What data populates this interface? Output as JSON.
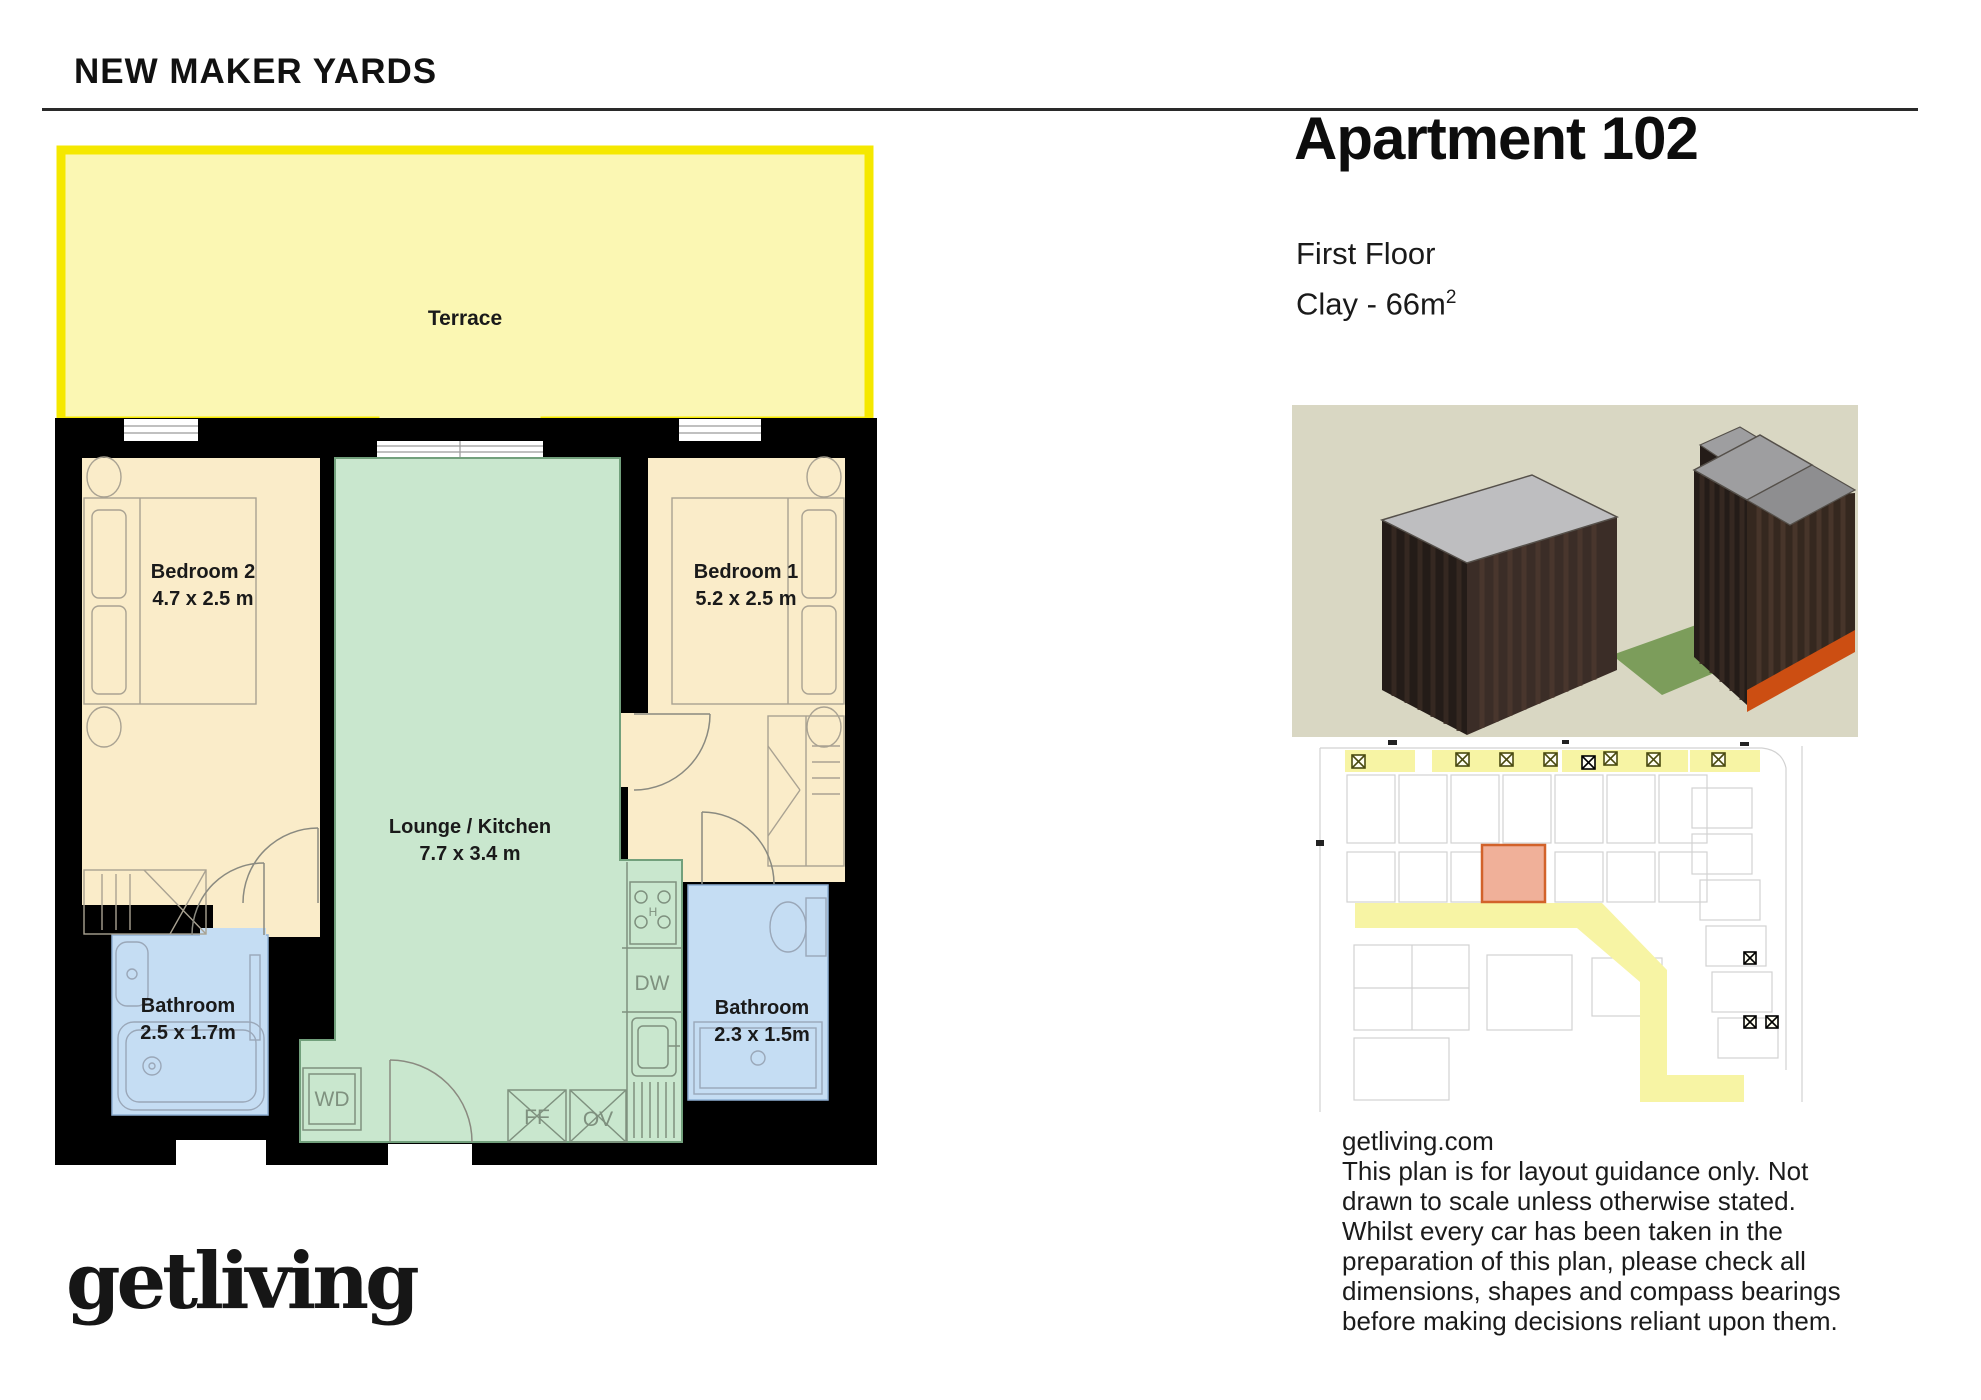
{
  "header": {
    "project_name": "NEW MAKER YARDS"
  },
  "apartment": {
    "title": "Apartment 102",
    "floor": "First Floor",
    "spec_prefix": "Clay - 66m",
    "spec_superscript": "2"
  },
  "floorplan": {
    "terrace": {
      "label": "Terrace"
    },
    "bedroom2": {
      "label": "Bedroom 2",
      "dims": "4.7 x 2.5 m"
    },
    "bedroom1": {
      "label": "Bedroom 1",
      "dims": "5.2 x 2.5 m"
    },
    "lounge": {
      "label": "Lounge / Kitchen",
      "dims": "7.7 x 3.4 m"
    },
    "bathroom_left": {
      "label": "Bathroom",
      "dims": "2.5 x 1.7m"
    },
    "bathroom_right": {
      "label": "Bathroom",
      "dims": "2.3 x 1.5m"
    },
    "appliances": {
      "washer_dryer": "WD",
      "dishwasher": "DW",
      "fridge_freezer": "FF",
      "oven": "OV",
      "hob": "H"
    },
    "colors": {
      "terrace_border": "#F5E800",
      "terrace_fill": "#FBF7B3",
      "bedroom_fill": "#FAECC9",
      "lounge_fill": "#C9E7CE",
      "bathroom_fill": "#C5DDF3",
      "wall": "#000000",
      "site_highlight_fill": "#F0B099",
      "site_highlight_border": "#D2622A",
      "site_corridor": "#F7F4A4",
      "render_background": "#D9D7C3"
    }
  },
  "disclaimer": {
    "website": "getliving.com",
    "lines": [
      "This plan is for layout guidance only. Not",
      "drawn to scale unless otherwise stated.",
      "Whilst every car has been taken in the",
      "preparation of this plan, please check all",
      "dimensions, shapes and compass bearings",
      "before making decisions reliant upon them."
    ]
  },
  "footer": {
    "brand": "getliving"
  }
}
